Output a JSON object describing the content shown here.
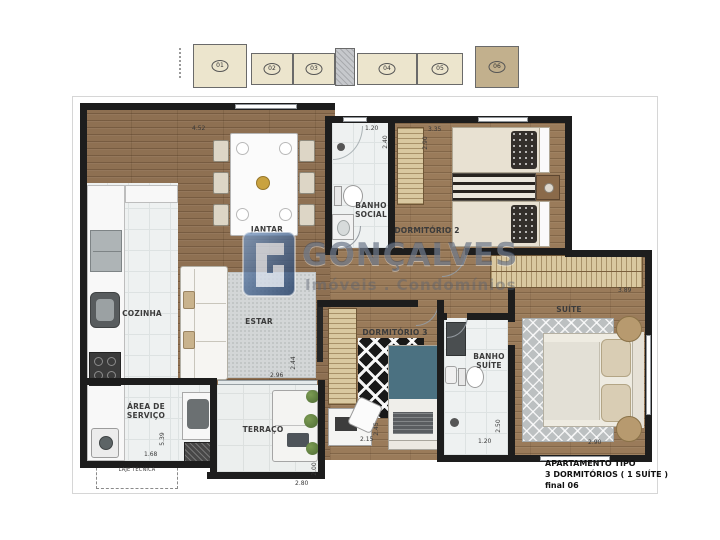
{
  "watermark": {
    "brand": "GONÇALVES",
    "tagline": "Imóveis . Condomínios"
  },
  "unit_info": {
    "line1": "APARTAMENTO  TIPO",
    "line2": "3 DORMITÓRIOS ( 1 SUÍTE )",
    "line3": "final 06"
  },
  "building": {
    "units": [
      {
        "num": "01"
      },
      {
        "num": "02"
      },
      {
        "num": "03"
      },
      {
        "num": "04"
      },
      {
        "num": "05"
      },
      {
        "num": "06"
      }
    ],
    "highlighted_unit": "06"
  },
  "rooms": {
    "jantar": {
      "label": "JANTAR",
      "dim_w": "4.52"
    },
    "estar": {
      "label": "ESTAR",
      "dim_w": "2.96",
      "dim_h": "2.44"
    },
    "cozinha": {
      "label": "COZINHA"
    },
    "area_servico": {
      "label": "ÁREA DE SERVIÇO",
      "dim_w": "1.68",
      "dim_h": "5.39"
    },
    "laje_tecnica": {
      "label": "LAJE TÉCNICA"
    },
    "terraco": {
      "label": "TERRAÇO",
      "dim_w": "2.80",
      "dim_h": "2.00"
    },
    "banho_social": {
      "label": "BANHO SOCIAL",
      "dim_w": "1.20",
      "dim_h": "2.40"
    },
    "dormitorio2": {
      "label": "DORMITÓRIO 2",
      "dim_w": "3.35",
      "dim_h": "2.90"
    },
    "dormitorio3": {
      "label": "DORMITÓRIO 3",
      "dim_w": "2.15",
      "dim_h": "2.45"
    },
    "banho_suite": {
      "label": "BANHO SUÍTE",
      "dim_w": "1.20",
      "dim_h": "2.50"
    },
    "suite": {
      "label": "SUÍTE",
      "dim_top": "3.89",
      "dim_w": "2.90"
    }
  },
  "colors": {
    "wall": "#1d1d1d",
    "wood_floor": "#8e7052",
    "tile_floor": "#eef1f1",
    "wardrobe": "#d9c8a0",
    "unit_fill": "#ece5cd",
    "unit_highlight": "#c2b08d",
    "watermark_blue": "#3a4862"
  }
}
